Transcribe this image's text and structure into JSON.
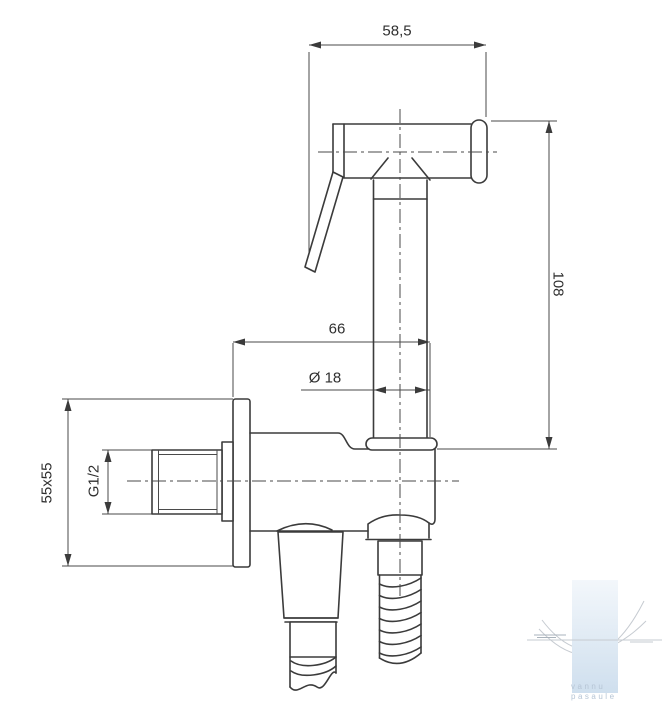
{
  "canvas": {
    "background": "#ffffff"
  },
  "drawing": {
    "type": "technical-dimension-drawing",
    "subject": "hand bidet sprayer with wall angle valve and hose",
    "line_color": "#3b3b3b",
    "dimensions": {
      "head_width": "58,5",
      "overall_height": "108",
      "depth": "66",
      "handle_diameter": "Ø 18",
      "wall_plate": "55x55",
      "thread": "G1/2"
    }
  },
  "watermark": {
    "line1": "vannu",
    "line2": "pasaule",
    "text_color": "#b6c5d5",
    "bar_top_color": "#f3f7fb",
    "bar_bottom_color": "#cfdfee",
    "swoosh_color": "#c6cbd1"
  }
}
